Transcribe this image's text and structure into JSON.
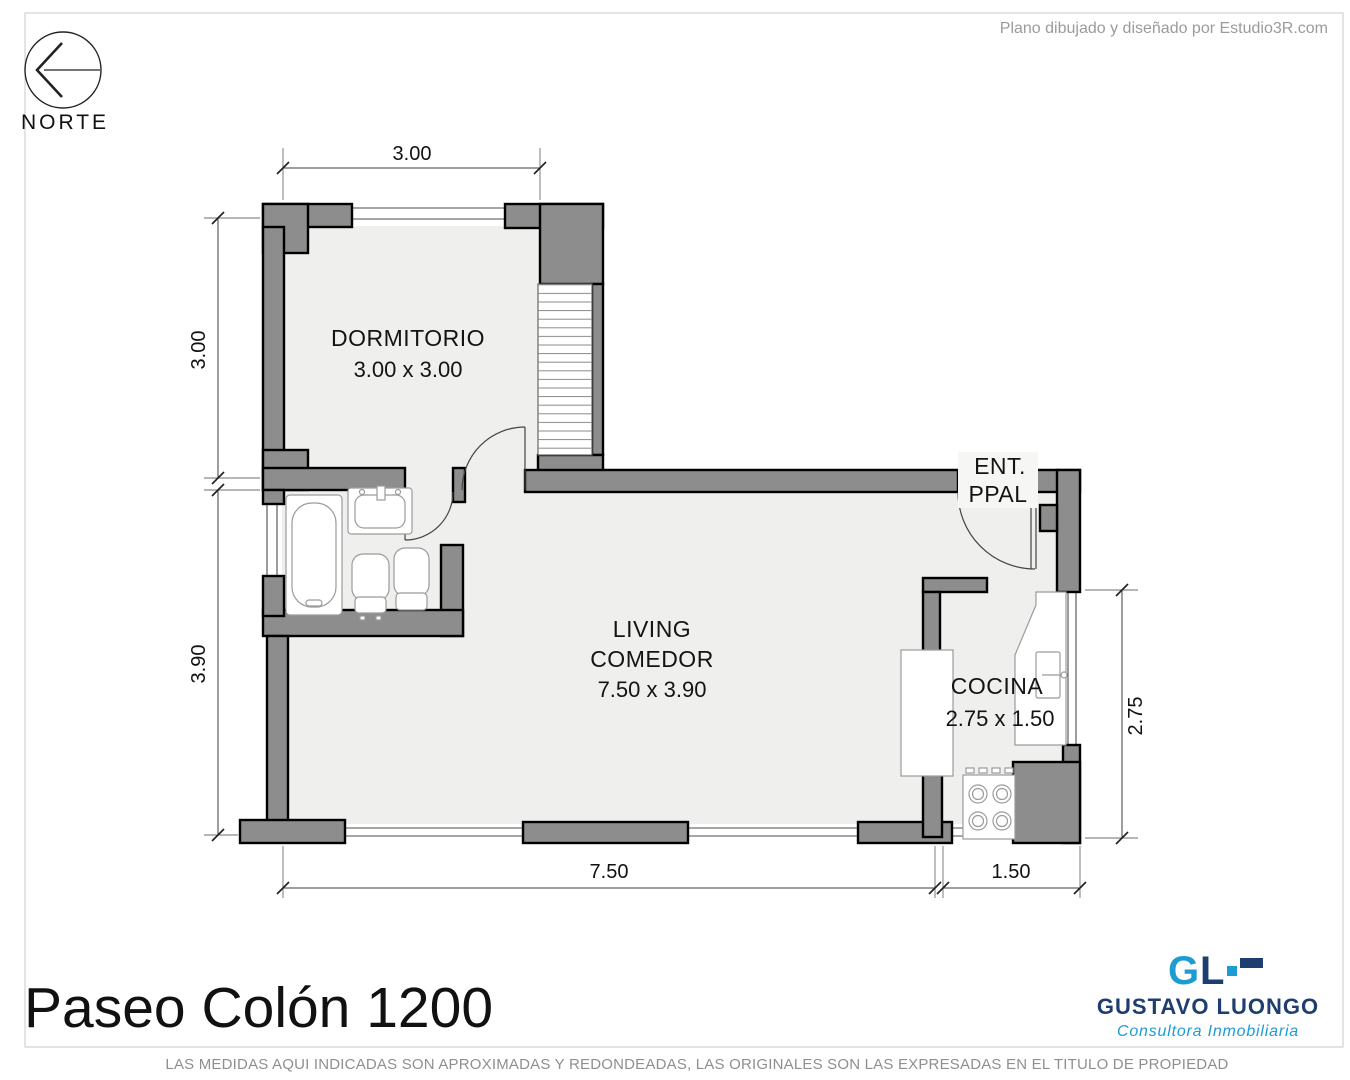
{
  "page": {
    "attribution": "Plano dibujado y diseñado por Estudio3R.com",
    "title": "Paseo Colón 1200",
    "disclaimer": "LAS MEDIDAS AQUI INDICADAS SON APROXIMADAS Y REDONDEADAS, LAS ORIGINALES SON LAS EXPRESADAS EN EL TITULO DE PROPIEDAD"
  },
  "compass": {
    "label": "NORTE"
  },
  "rooms": {
    "dormitorio": {
      "name": "DORMITORIO",
      "size": "3.00 x 3.00"
    },
    "living": {
      "line1": "LIVING",
      "line2": "COMEDOR",
      "size": "7.50 x 3.90"
    },
    "cocina": {
      "name": "COCINA",
      "size": "2.75 x 1.50"
    },
    "entrance": {
      "line1": "ENT.",
      "line2": "PPAL"
    }
  },
  "dimensions": {
    "top_width": "3.00",
    "left_upper": "3.00",
    "left_lower": "3.90",
    "bottom_main": "7.50",
    "bottom_kitchen": "1.50",
    "right_kitchen": "2.75"
  },
  "branding": {
    "logo_g": "G",
    "logo_l": "L",
    "company": "GUSTAVO LUONGO",
    "tagline": "Consultora Inmobiliaria",
    "colors": {
      "light_blue": "#1d9cd4",
      "navy": "#1d3e6e"
    }
  }
}
